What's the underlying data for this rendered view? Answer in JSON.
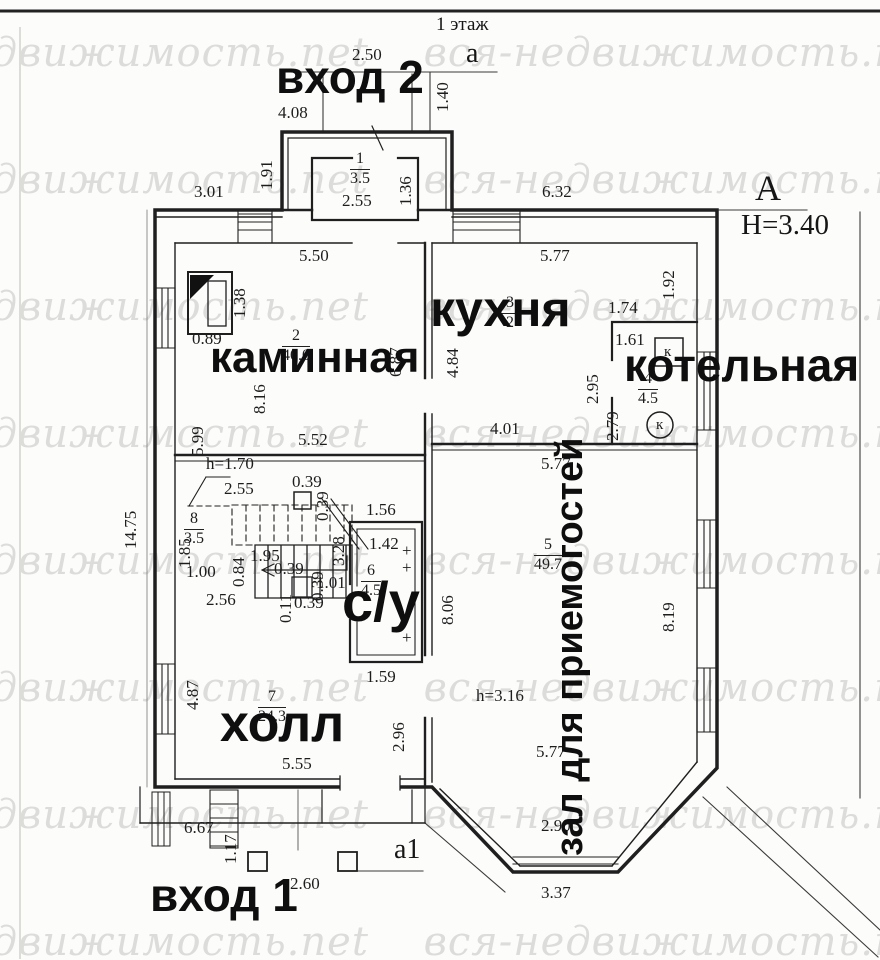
{
  "page": {
    "title": "1 этаж",
    "watermark": "вся-недвижимость.net"
  },
  "axes": {
    "a_top": "a",
    "a1_bottom": "a1",
    "A_right": "А",
    "height_note": "Н=3.40"
  },
  "entrances": {
    "entrance_2": "вход 2",
    "entrance_1": "вход 1"
  },
  "rooms": {
    "tambour": {
      "number": "1",
      "area": "3.5"
    },
    "kaminnaya": {
      "number": "2",
      "area": "40.0",
      "label": "каминная"
    },
    "kitchen": {
      "number": "3",
      "area": "2",
      "label": "кухня"
    },
    "boiler": {
      "number": "4",
      "area": "4.5",
      "label": "котельная",
      "k_square": "к",
      "k_circle": "к"
    },
    "zal": {
      "number": "5",
      "area": "49.7",
      "label": "зал для приемогостей"
    },
    "bathroom": {
      "number": "6",
      "area": "4.5",
      "label": "с/у"
    },
    "hall": {
      "number": "7",
      "area": "24.3",
      "label": "холл"
    },
    "stairs": {
      "number": "8",
      "area": "3.5"
    }
  },
  "dimensions": [
    {
      "t": "2.50",
      "x": 352,
      "y": 46
    },
    {
      "t": "4.08",
      "x": 278,
      "y": 104
    },
    {
      "t": "1.40",
      "x": 434,
      "y": 112,
      "v": 1
    },
    {
      "t": "1.91",
      "x": 258,
      "y": 190,
      "v": 1
    },
    {
      "t": "3.01",
      "x": 194,
      "y": 183
    },
    {
      "t": "2.55",
      "x": 342,
      "y": 192
    },
    {
      "t": "1.36",
      "x": 397,
      "y": 206,
      "v": 1
    },
    {
      "t": "6.32",
      "x": 542,
      "y": 183
    },
    {
      "t": "5.50",
      "x": 299,
      "y": 247
    },
    {
      "t": "1.38",
      "x": 231,
      "y": 318,
      "v": 1
    },
    {
      "t": "0.89",
      "x": 192,
      "y": 330
    },
    {
      "t": "8.16",
      "x": 251,
      "y": 414,
      "v": 1
    },
    {
      "t": "6.87",
      "x": 387,
      "y": 377,
      "v": 1
    },
    {
      "t": "5.99",
      "x": 189,
      "y": 456,
      "v": 1
    },
    {
      "t": "5.52",
      "x": 298,
      "y": 431
    },
    {
      "t": "14.75",
      "x": 122,
      "y": 549,
      "v": 1
    },
    {
      "t": "5.77",
      "x": 540,
      "y": 247
    },
    {
      "t": "4.84",
      "x": 444,
      "y": 378,
      "v": 1
    },
    {
      "t": "4.01",
      "x": 490,
      "y": 420
    },
    {
      "t": "2.95",
      "x": 584,
      "y": 404,
      "v": 1
    },
    {
      "t": "1.92",
      "x": 660,
      "y": 300,
      "v": 1
    },
    {
      "t": "1.74",
      "x": 608,
      "y": 299
    },
    {
      "t": "1.61",
      "x": 615,
      "y": 331
    },
    {
      "t": "2.79",
      "x": 604,
      "y": 441,
      "v": 1
    },
    {
      "t": "h=1.70",
      "x": 206,
      "y": 455
    },
    {
      "t": "2.55",
      "x": 224,
      "y": 480
    },
    {
      "t": "0.39",
      "x": 292,
      "y": 473
    },
    {
      "t": "0.39",
      "x": 314,
      "y": 521,
      "v": 1
    },
    {
      "t": "1.85",
      "x": 176,
      "y": 568,
      "v": 1
    },
    {
      "t": "1.00",
      "x": 186,
      "y": 563
    },
    {
      "t": "0.84",
      "x": 230,
      "y": 587,
      "v": 1
    },
    {
      "t": "1.95",
      "x": 250,
      "y": 547
    },
    {
      "t": "0.39",
      "x": 274,
      "y": 560
    },
    {
      "t": "2.56",
      "x": 206,
      "y": 591
    },
    {
      "t": "0.11",
      "x": 277,
      "y": 623,
      "v": 1
    },
    {
      "t": "0.39",
      "x": 294,
      "y": 594
    },
    {
      "t": "0.39",
      "x": 309,
      "y": 601,
      "v": 1
    },
    {
      "t": "1.01",
      "x": 316,
      "y": 574
    },
    {
      "t": "1.56",
      "x": 366,
      "y": 501
    },
    {
      "t": "3.28",
      "x": 330,
      "y": 566,
      "v": 1
    },
    {
      "t": "1.42",
      "x": 369,
      "y": 535
    },
    {
      "t": "1.59",
      "x": 366,
      "y": 668
    },
    {
      "t": "4.87",
      "x": 184,
      "y": 710,
      "v": 1
    },
    {
      "t": "5.55",
      "x": 282,
      "y": 755
    },
    {
      "t": "2.96",
      "x": 390,
      "y": 752,
      "v": 1
    },
    {
      "t": "5.77",
      "x": 541,
      "y": 455
    },
    {
      "t": "8.06",
      "x": 439,
      "y": 625,
      "v": 1
    },
    {
      "t": "8.19",
      "x": 660,
      "y": 632,
      "v": 1
    },
    {
      "t": "h=3.16",
      "x": 476,
      "y": 687
    },
    {
      "t": "5.77",
      "x": 536,
      "y": 743
    },
    {
      "t": "2.90",
      "x": 541,
      "y": 817
    },
    {
      "t": "3.37",
      "x": 541,
      "y": 884
    },
    {
      "t": "6.67",
      "x": 184,
      "y": 819
    },
    {
      "t": "1.17",
      "x": 222,
      "y": 864,
      "v": 1
    },
    {
      "t": "2.60",
      "x": 290,
      "y": 875
    },
    {
      "t": "+",
      "x": 402,
      "y": 542
    },
    {
      "t": "+",
      "x": 402,
      "y": 559
    },
    {
      "t": "+",
      "x": 402,
      "y": 629
    }
  ]
}
